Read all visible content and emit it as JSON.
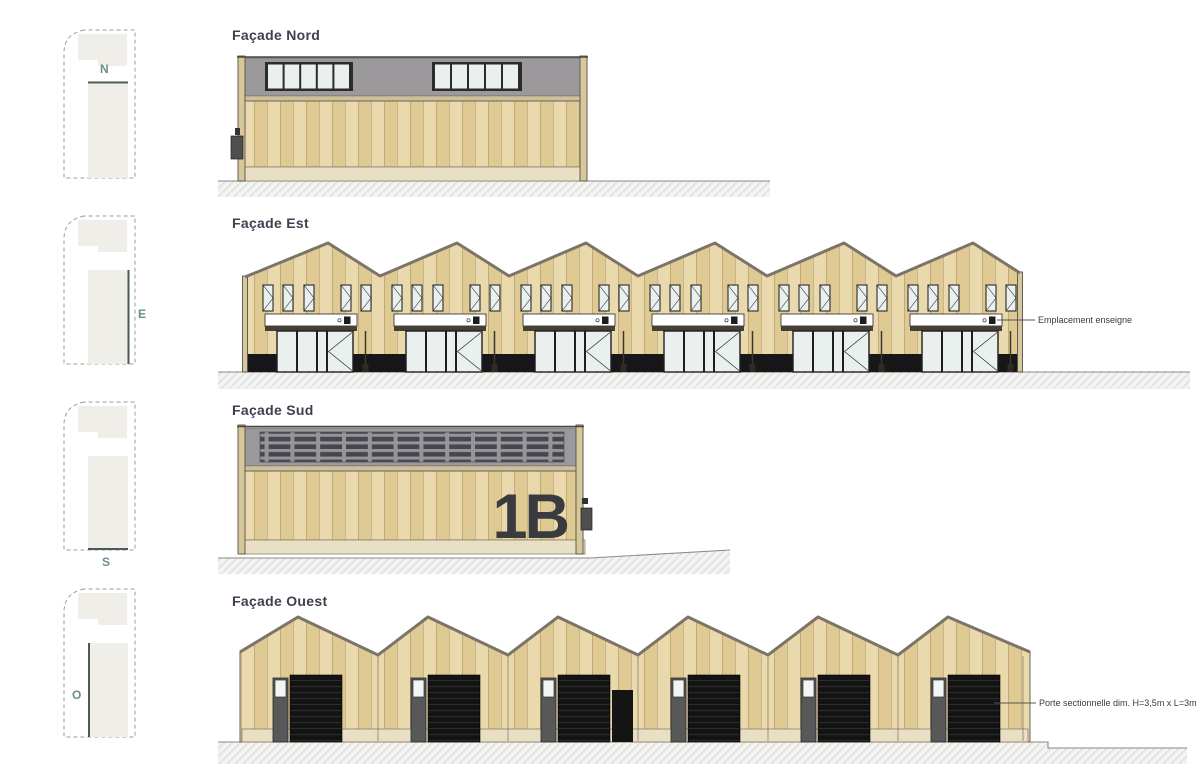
{
  "colors": {
    "title": "#3d414f",
    "compass": "#6a8f89",
    "accent": "#4a5a55",
    "wood-light": "#ead9ad",
    "wood-dark": "#e0ca94",
    "gray-band": "#9b999c",
    "glass": "#eaf0ee",
    "frame": "#2b2b2b",
    "plinth": "#17171a",
    "base": "#e9dfc5",
    "post": "#d8c79a",
    "roof": "#7d7468",
    "door-gray": "#585858",
    "lintel": "#453f35",
    "fascia": "#cfc09c",
    "louver-bg": "#96969a",
    "louver-slat": "#46474e",
    "ground-fill": "#f3f3f1",
    "ground-line": "#8a8a88",
    "hatch-line": "#dcdcda",
    "annotation": "#3a3a3a"
  },
  "keyplans": {
    "nord": {
      "letter": "N"
    },
    "est": {
      "letter": "E"
    },
    "sud": {
      "letter": "S"
    },
    "ouest": {
      "letter": "O"
    }
  },
  "facades": {
    "nord": {
      "title": "Façade Nord"
    },
    "est": {
      "title": "Façade Est",
      "annotation": "Emplacement enseigne"
    },
    "sud": {
      "title": "Façade Sud",
      "building_number": "1B"
    },
    "ouest": {
      "title": "Façade Ouest",
      "annotation": "Porte sectionnelle dim. H=3,5m x L=3m"
    }
  }
}
